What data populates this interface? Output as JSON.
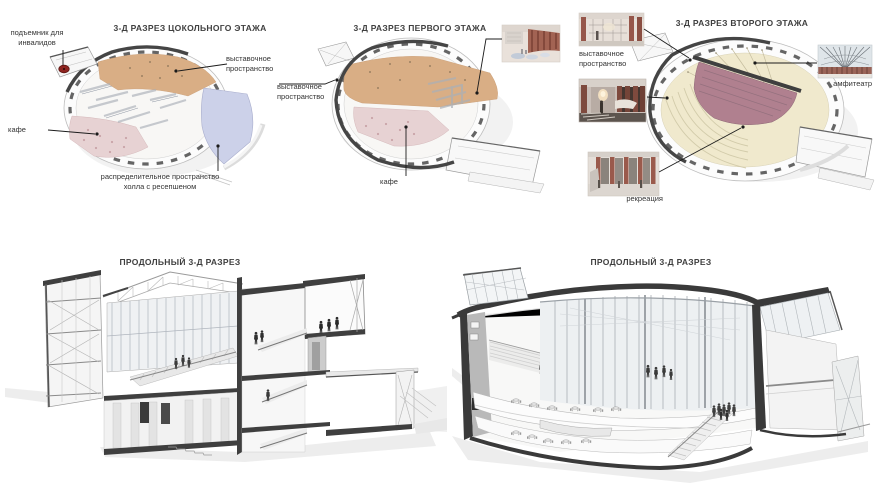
{
  "board": {
    "background": "#ffffff"
  },
  "colors": {
    "exhibition_space": "#d9ae85",
    "cafe_zone": "#e7d2d3",
    "distribution_hall": "#ccd1e9",
    "amphitheater_zone": "#b0808f",
    "second_floor_deck": "#f0e9cd",
    "disabled_lift_marker": "#8e2420",
    "section_cut": "#3f3f3f"
  },
  "panels": {
    "basement": {
      "title": "3-Д РАЗРЕЗ ЦОКОЛЬНОГО ЭТАЖА",
      "labels": {
        "lift": "подъемник для инвалидов",
        "exhibition": "выставочное пространство",
        "cafe": "кафе",
        "distribution": "распределительное пространство холла с ресепшеном"
      }
    },
    "first_floor": {
      "title": "3-Д РАЗРЕЗ ПЕРВОГО ЭТАЖА",
      "labels": {
        "exhibition": "выставочное пространство",
        "cafe": "кафе"
      }
    },
    "second_floor": {
      "title": "3-Д РАЗРЕЗ ВТОРОГО ЭТАЖА",
      "labels": {
        "exhibition": "выставочное пространство",
        "amphitheater": "амфитеатр",
        "recreation": "рекреация"
      }
    },
    "section_left": {
      "title": "ПРОДОЛЬНЫЙ 3-Д РАЗРЕЗ"
    },
    "section_right": {
      "title": "ПРОДОЛЬНЫЙ 3-Д РАЗРЕЗ"
    }
  }
}
